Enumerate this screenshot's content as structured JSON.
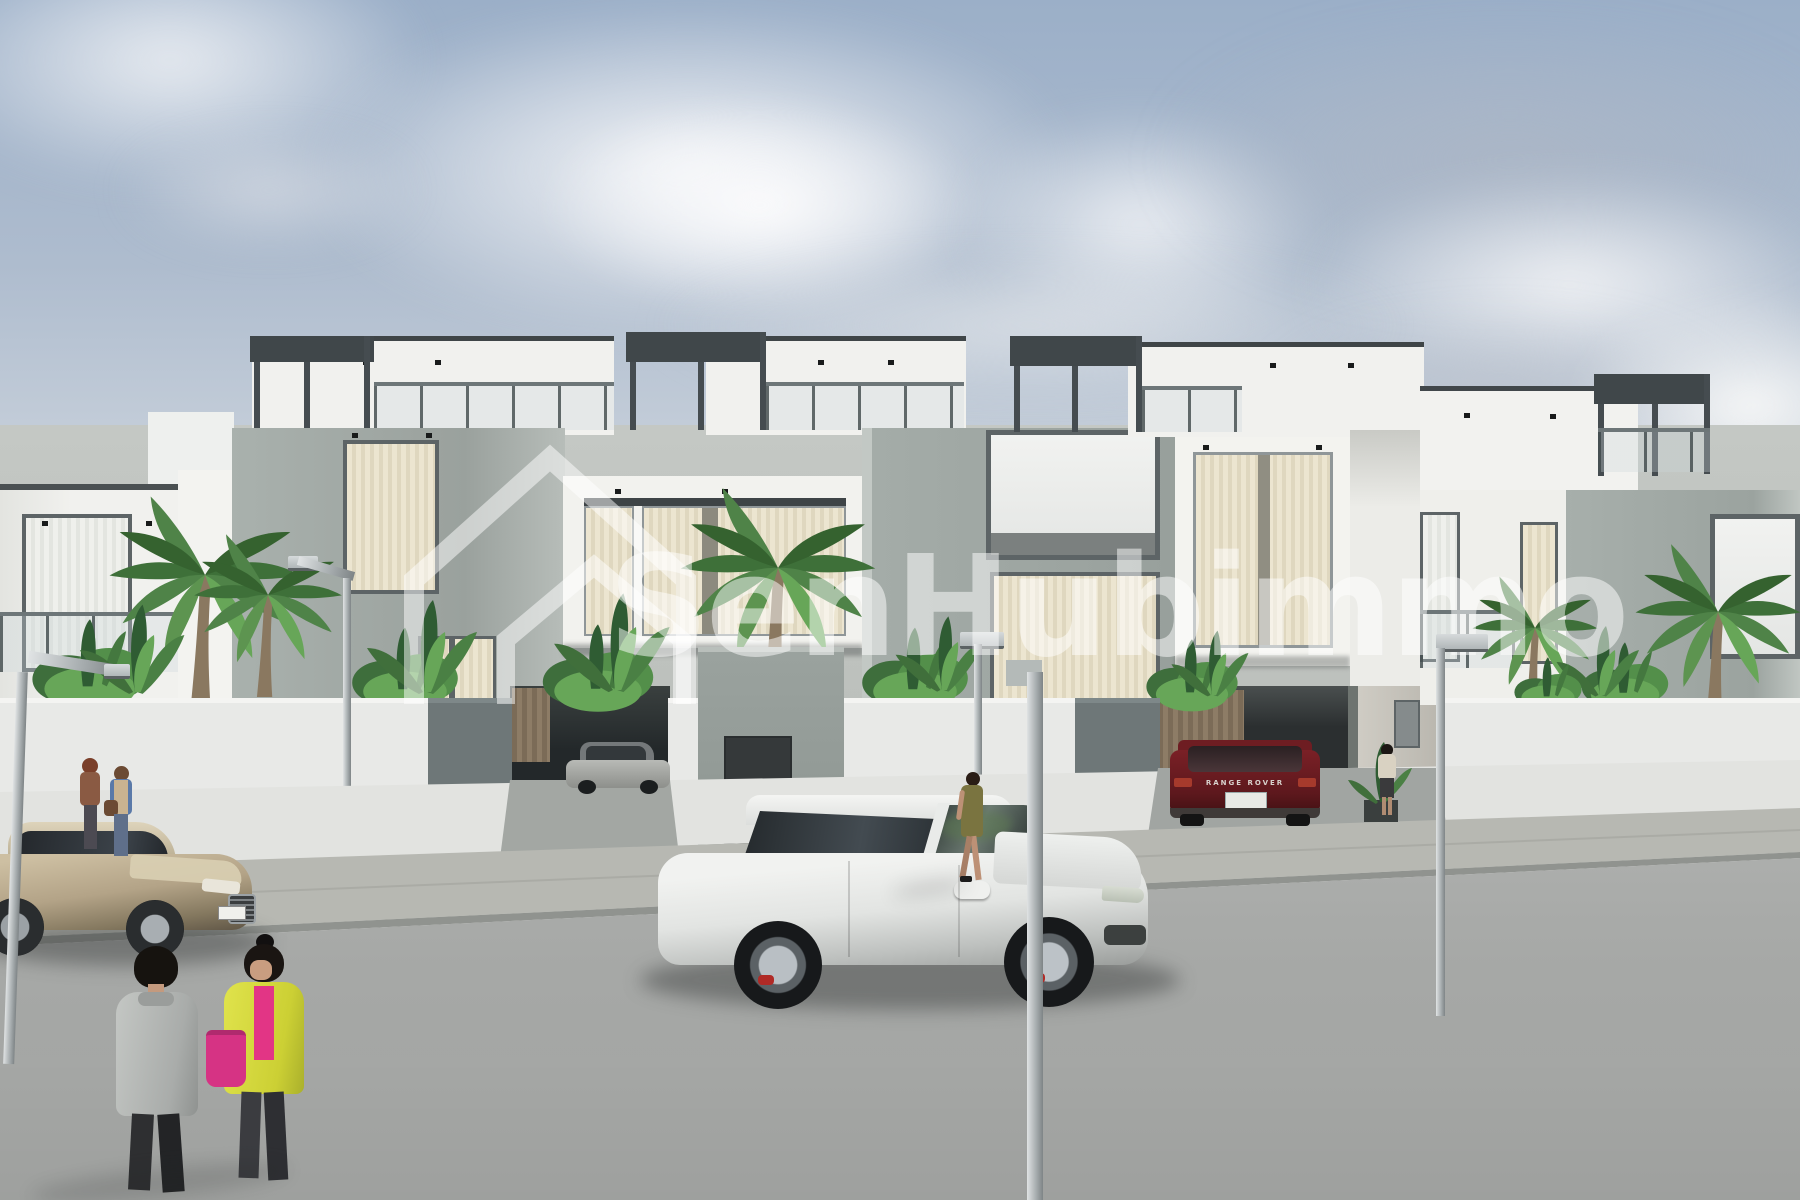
{
  "watermark": {
    "brand_text": "SenHubimmo",
    "logo_icon": "nested-house-outline-icon",
    "text_color": "#ffffff",
    "text_opacity": 0.5
  },
  "vehicles": {
    "sedan": {
      "kind": "champagne-sedan-left-lane",
      "color_hex": "#b7a88c"
    },
    "suv": {
      "kind": "white-suv-foreground",
      "color_hex": "#eceeec",
      "caliper_color_hex": "#b02a26"
    },
    "parked_suv": {
      "kind": "dark-red-suv-in-carport",
      "color_hex": "#6e1b20",
      "badge_text": "RANGE ROVER",
      "plate_color_hex": "#e8e9e5"
    },
    "carport_car": {
      "kind": "silver-car-in-carport",
      "color_hex": "#9c9e9a"
    }
  },
  "people": {
    "count": 6,
    "items": [
      {
        "name": "man-gray-coat-foreground",
        "colors": [
          "#b8bbb8",
          "#2e2f31"
        ]
      },
      {
        "name": "woman-yellow-cardigan-pink-bag",
        "colors": [
          "#d6d943",
          "#e23585",
          "#d63384"
        ]
      },
      {
        "name": "woman-auburn-hair-brown-top",
        "colors": [
          "#8a5a43",
          "#7a3f2a"
        ]
      },
      {
        "name": "woman-blue-top-tan-vest",
        "colors": [
          "#5a79a8",
          "#c9b391"
        ]
      },
      {
        "name": "woman-olive-dress-sidewalk",
        "colors": [
          "#7a7440"
        ]
      },
      {
        "name": "woman-beige-top-entrance",
        "colors": [
          "#d9d2c2"
        ]
      }
    ]
  },
  "palette": {
    "sky_top": "#9bafc8",
    "sky_horizon": "#ededea",
    "cloud": "#f4f5f6",
    "facade_white": "#f1f1ee",
    "facade_gray": "#a3aba7",
    "frame_dark": "#4e5658",
    "curtain_cream": "#ece5d0",
    "wall_white": "#e8e9e7",
    "wall_dark_panel": "#6e7778",
    "wood_slats": "#8a7863",
    "sidewalk": "#b7b8b2",
    "road": "#a8aaa8",
    "foliage_dark": "#2f5c33",
    "foliage_mid": "#4f8348",
    "foliage_light": "#67a658"
  },
  "scene": {
    "kind": "3d-architectural-exterior-render",
    "subject": "row of modern two-storey white and grey villas with roof terraces, front gardens with palms, street with cars and pedestrians"
  }
}
